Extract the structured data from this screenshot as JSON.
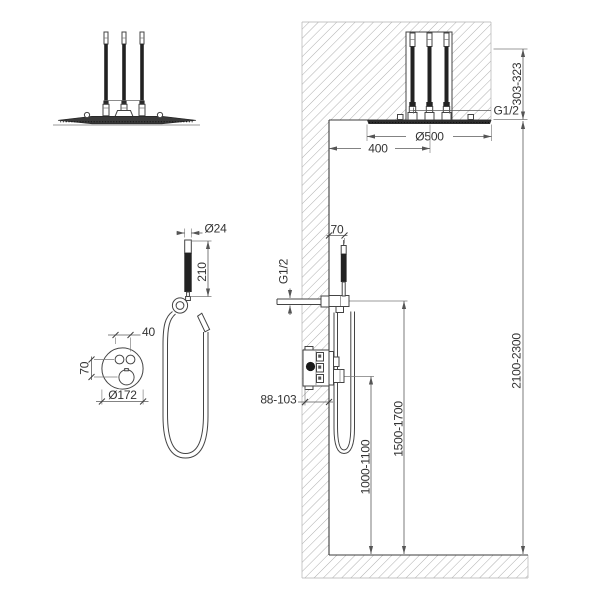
{
  "labels": {
    "overhead_shower": {
      "connection": "G1/2",
      "mounting_height": "303-323",
      "head_diameter": "Ø500",
      "distance_from_wall": "400"
    },
    "hand_shower": {
      "handle_diameter": "Ø24",
      "handle_length": "210"
    },
    "control_valve": {
      "button_spacing": "40",
      "button_to_knob": "70",
      "plate_diameter": "Ø172"
    },
    "wall_section": {
      "holder_projection": "70",
      "outlet_connection": "G1/2",
      "valve_recess_depth": "88-103",
      "valve_height": "1000-1100",
      "holder_height": "1500-1700",
      "ceiling_height": "2100-2300"
    }
  },
  "colors": {
    "background": "#ffffff",
    "object_line": "#444444",
    "dimension_line": "#5a5a5a",
    "hatch": "#9b9b9b",
    "text": "#333333",
    "dark_fill": "#222222"
  }
}
